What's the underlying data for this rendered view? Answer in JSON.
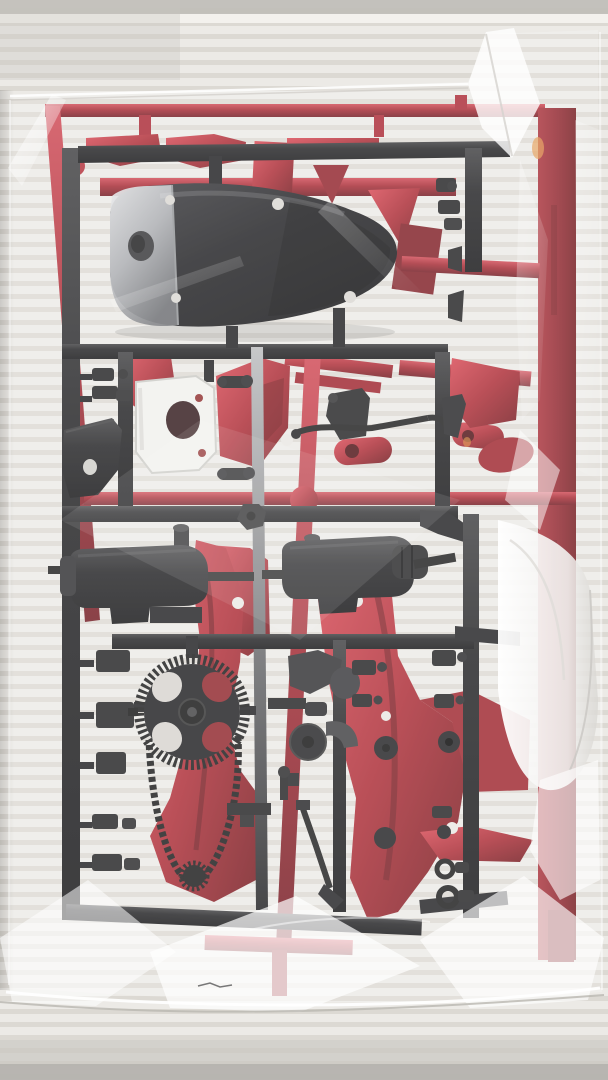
{
  "page": {
    "title": "Photograph of model kit sprues sealed in a clear bag"
  },
  "scene": {
    "description": "Photograph of an unopened clear plastic bag holding two plastic model-kit sprues: a black runner carrying motorcycle engine and chassis parts (fuel tank shell, white number plate, mudguard, two exhaust silencers, rear sprocket with drive chain, handlebar linkages and many small fittings) in front of a metallic red runner carrying frame halves, fenders and bodywork panels. The bag lies on a pale grey ridged surface.",
    "setting": "pale grey ridged tabletop",
    "bag": {
      "material": "clear polyethylene",
      "state": "sealed, wrinkled, glossy highlights"
    },
    "sprues": [
      {
        "id": "black-runner",
        "color_key": "black-main",
        "parts": [
          "fuel tank shell with chrome-lit end",
          "white front number plate",
          "rear mudguard",
          "exhaust silencer left",
          "exhaust silencer right",
          "rear sprocket with drive chain",
          "handlebar and ball-joint linkages",
          "side stand",
          "small clips, discs and eyelet rings"
        ]
      },
      {
        "id": "red-runner",
        "color_key": "red-mid",
        "parts": [
          "frame half left",
          "frame half right",
          "fender and fairing panels",
          "long body rails",
          "fork tube with ball end",
          "oval brackets",
          "wide runner rail with embossed lettering"
        ]
      }
    ]
  },
  "colors": {
    "bg-light": "#eceae6",
    "bg-stripe": "#dbd8d2",
    "bg-dark": "#c2bfba",
    "red-bright": "#c5323d",
    "red-mid": "#a2222c",
    "red-dark": "#7c1820",
    "red-deep": "#581016",
    "black-main": "#181818",
    "black-soft": "#262626",
    "gray-rod": "#9a9b9e",
    "chrome": "#d2d3d6",
    "white-part": "#f1f0ed",
    "bag-white": "#ffffff"
  }
}
